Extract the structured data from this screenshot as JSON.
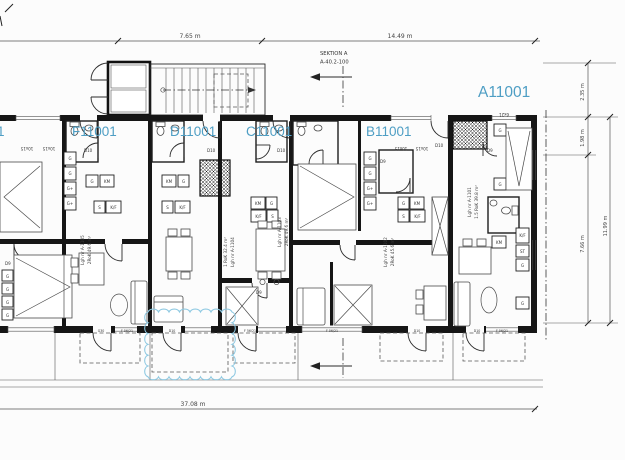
{
  "apartments": {
    "partial": "1",
    "f": "F11001",
    "d": "D11001",
    "c": "C11001",
    "b": "B11001",
    "a": "A11001"
  },
  "units": {
    "f": {
      "l1": "Lgh nr A-1105",
      "l2": "2RoK 49.6 m²"
    },
    "d": {
      "l1": "1 RoK 32.4 m²",
      "l2": "Lgh nr A-1104"
    },
    "c": {
      "l1": "Lgh nr A-1103",
      "l2": "2RoK 49.6 m²"
    },
    "b": {
      "l1": "Lgh nr A-1102",
      "l2": "2RoK 45.6 m²"
    },
    "a": {
      "l1": "Lgh nr A-1101",
      "l2": "1.5 RoK 39.8 m²"
    }
  },
  "section": {
    "l1": "SEKTION A",
    "l2": "A-40.2-100"
  },
  "dimensions": {
    "top_left": "7.65 m",
    "top_right": "14.49 m",
    "bottom": "37.08 m",
    "right_1": "2.35 m",
    "right_2": "1.98 m",
    "right_3": "7.66 m",
    "right_total": "11.99 m"
  },
  "doors": {
    "entry": "D10",
    "interior": "D9"
  },
  "fixtures": {
    "km": "KM",
    "kf": "K/F",
    "stove": "S",
    "g": "G",
    "gplus": "G+",
    "st": "ST"
  },
  "windows": {
    "w1": "10x15",
    "wa": "6x21",
    "f": "F 56/21",
    "g30": "G30"
  },
  "colors": {
    "accent_blue": "#4e9ec4",
    "cloud_blue": "#8ec9e2",
    "ink": "#161616"
  }
}
